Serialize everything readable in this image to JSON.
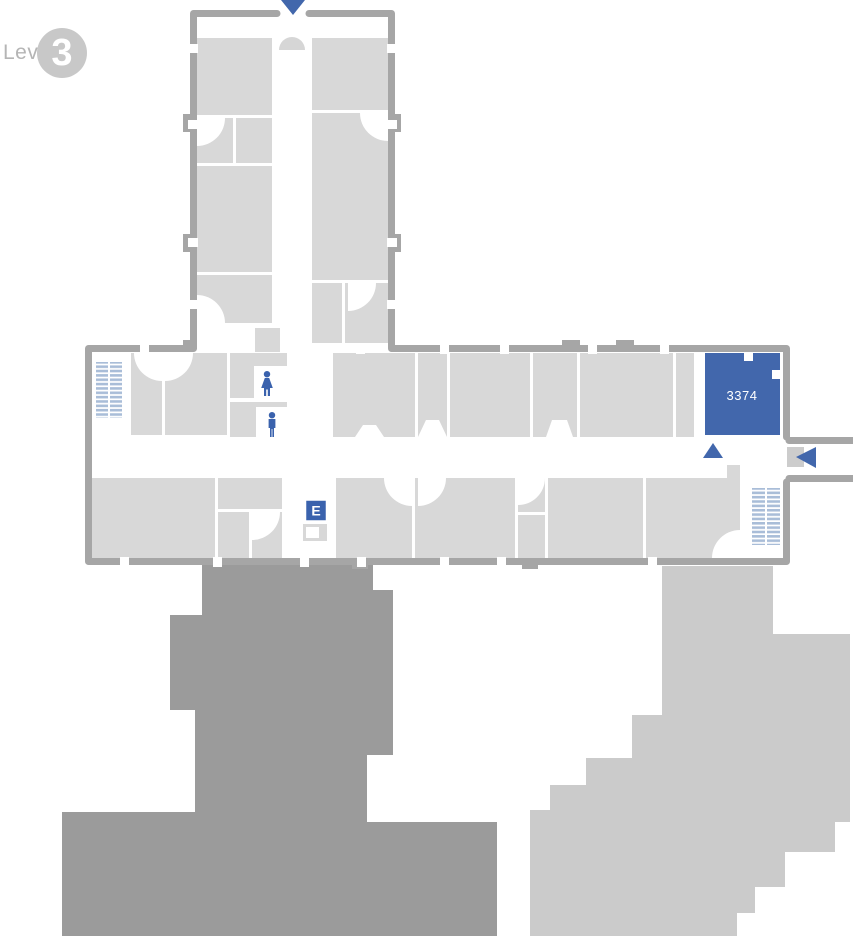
{
  "level_badge": {
    "prefix_label": "Level",
    "level_number": "3"
  },
  "highlight_room": {
    "label": "3374"
  },
  "elevator": {
    "label": "E"
  },
  "markers": {
    "north_entrance": "down-triangle-icon",
    "east_entrance": "left-triangle-icon",
    "corridor_location": "up-triangle-icon"
  },
  "restrooms": {
    "women": "woman-icon",
    "men": "man-icon"
  },
  "stairs": {
    "left": "stairs-icon",
    "right": "stairs-icon"
  },
  "colors": {
    "accent_blue": "#4267ac",
    "icon_blue": "#3a62ad",
    "stairs_blue": "#a9bdd8",
    "wall_gray": "#a6a6a6",
    "room_gray": "#d8d8d8",
    "door_swing_gray": "#d6d6d6",
    "dark_building_gray": "#9b9b9b",
    "light_building_gray": "#cbcbcb",
    "badge_circle_gray": "#c8c8c8",
    "level_label_gray": "#b5b5b5",
    "white": "#ffffff"
  }
}
